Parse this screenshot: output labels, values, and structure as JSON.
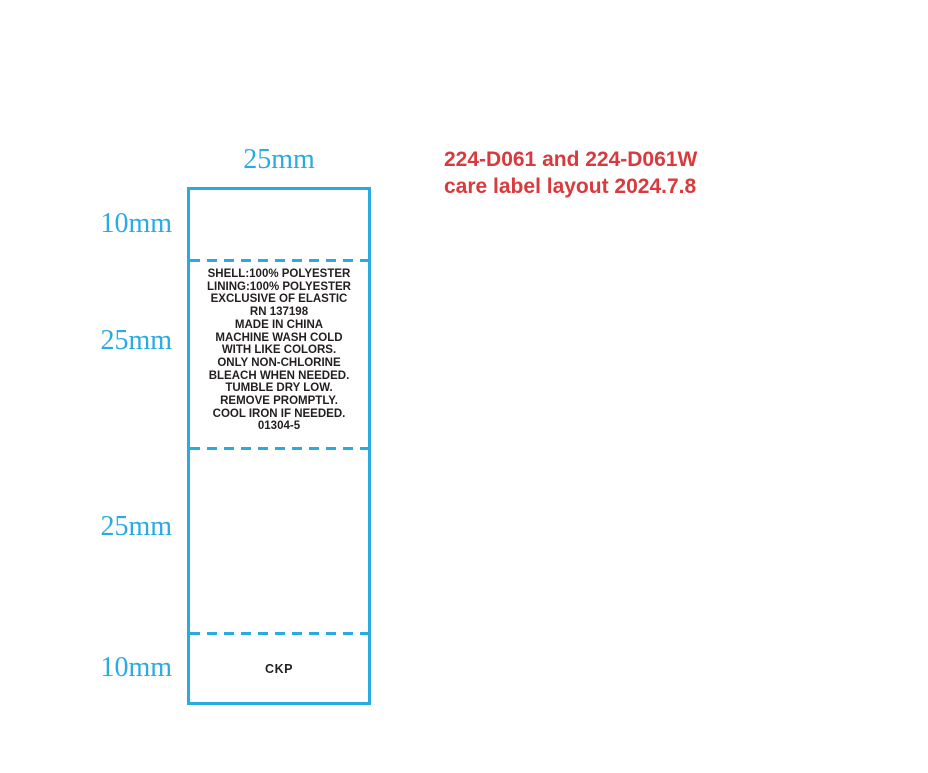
{
  "title": {
    "line1": "224-D061 and 224-D061W",
    "line2": "care label layout 2024.7.8",
    "color": "#D93A3E"
  },
  "dimensions": {
    "color": "#29ABE2",
    "top_width": "25mm",
    "left_sections": [
      "10mm",
      "25mm",
      "25mm",
      "10mm"
    ]
  },
  "label": {
    "border_color": "#29ABE2",
    "text_color": "#231F20",
    "care_text_lines": [
      "SHELL:100% POLYESTER",
      "LINING:100% POLYESTER",
      "EXCLUSIVE OF ELASTIC",
      "RN 137198",
      "MADE IN CHINA",
      "MACHINE WASH COLD",
      "WITH LIKE COLORS.",
      "ONLY NON-CHLORINE",
      "BLEACH WHEN NEEDED.",
      "TUMBLE DRY LOW.",
      "REMOVE PROMPTLY.",
      "COOL IRON IF NEEDED.",
      "01304-5"
    ],
    "footer_text": "CKP"
  }
}
